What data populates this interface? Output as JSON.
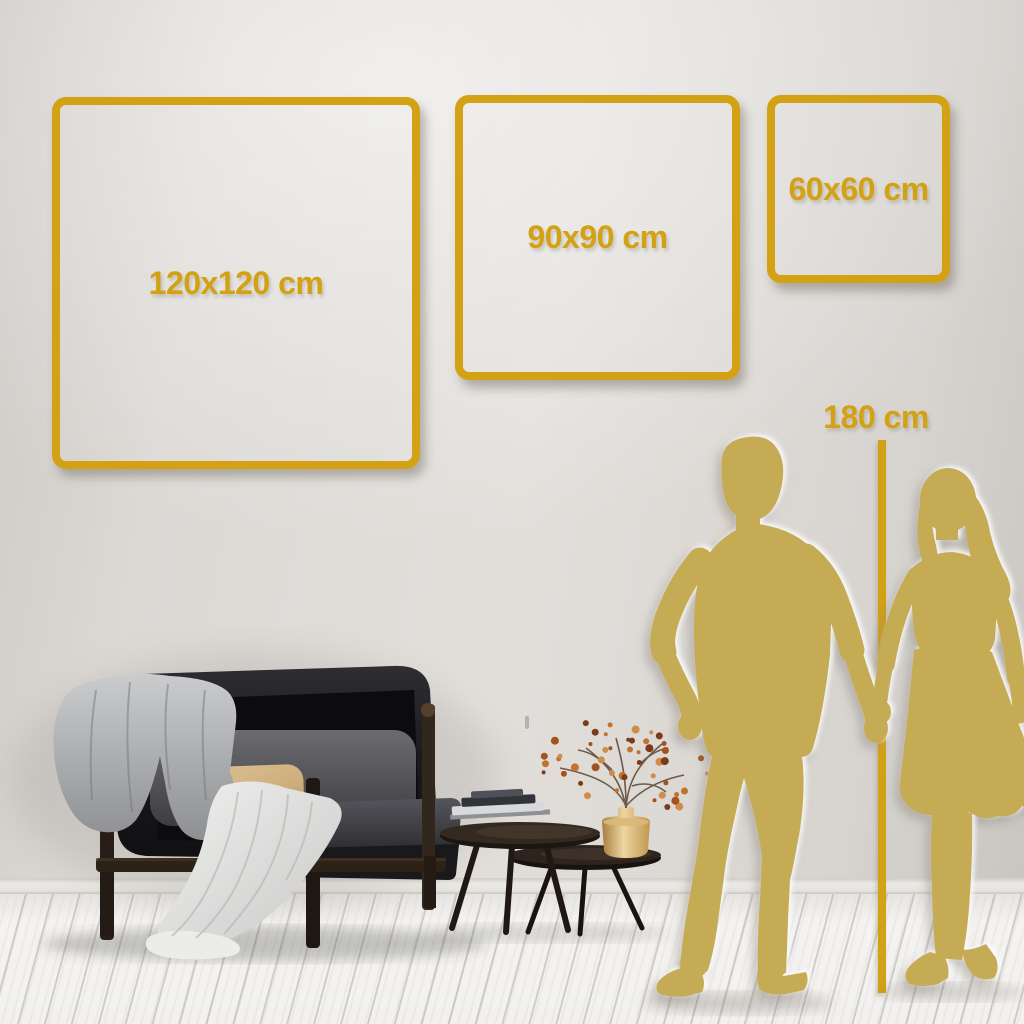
{
  "size_guide": {
    "frames": [
      {
        "name": "frame-120",
        "label": "120x120 cm",
        "width_cm": 120,
        "height_cm": 120
      },
      {
        "name": "frame-90",
        "label": "90x90 cm",
        "width_cm": 90,
        "height_cm": 90
      },
      {
        "name": "frame-60",
        "label": "60x60 cm",
        "width_cm": 60,
        "height_cm": 60
      }
    ],
    "person_height": {
      "label": "180 cm",
      "value_cm": 180
    }
  },
  "colors": {
    "accent_gold": "#D3A114",
    "silhouette_gold": "#C6AB55",
    "wall": "#D9D6D2",
    "floor": "#F2F1EF",
    "wood_dark": "#2B211A",
    "pillow_beige": "#D4B586",
    "berry_tones": [
      "#A4521F",
      "#C1722E",
      "#7D3A16",
      "#D28C4A"
    ]
  },
  "decor": {
    "items": [
      "dark-velvet-loveseat",
      "gray-throw-blanket",
      "white-draped-blanket",
      "gray-back-cushion",
      "beige-lumbar-pillow",
      "nesting-coffee-tables",
      "stacked-books",
      "brass-vase",
      "dried-flower-branches",
      "man-silhouette",
      "woman-silhouette"
    ]
  }
}
